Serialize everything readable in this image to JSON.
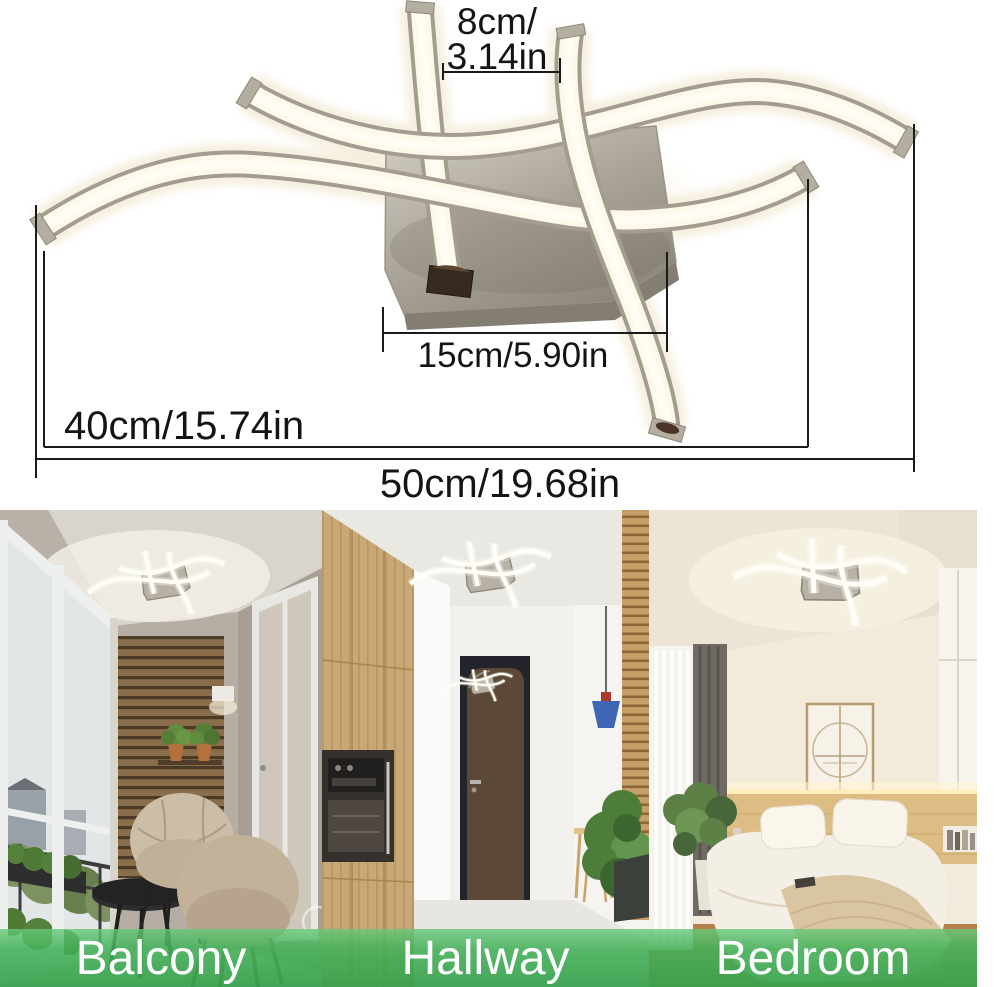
{
  "product_diagram": {
    "dimensions": {
      "gap_width": {
        "line1": "8cm/",
        "line2": "3.14in"
      },
      "plate_width": {
        "label": "15cm/5.90in"
      },
      "arm_length": {
        "label": "40cm/15.74in"
      },
      "overall_width": {
        "label": "50cm/19.68in"
      }
    }
  },
  "rooms": [
    {
      "label": "Balcony"
    },
    {
      "label": "Hallway"
    },
    {
      "label": "Bedroom"
    }
  ],
  "colors": {
    "background": "#ffffff",
    "dimension_text": "#141414",
    "dimension_line": "#1a1a1a",
    "label_bar_green": "#4ab262",
    "label_bar_green_dark": "#36a04c",
    "label_text": "#ffffff",
    "lamp_metal": "#a49e91",
    "lamp_led_warm": "#fdf8ea",
    "mount_plate": "#b3ada1",
    "wood_slats": "#8a6d4a",
    "hall_wood": "#c9a877",
    "bedroom_wood": "#ddbd84"
  }
}
